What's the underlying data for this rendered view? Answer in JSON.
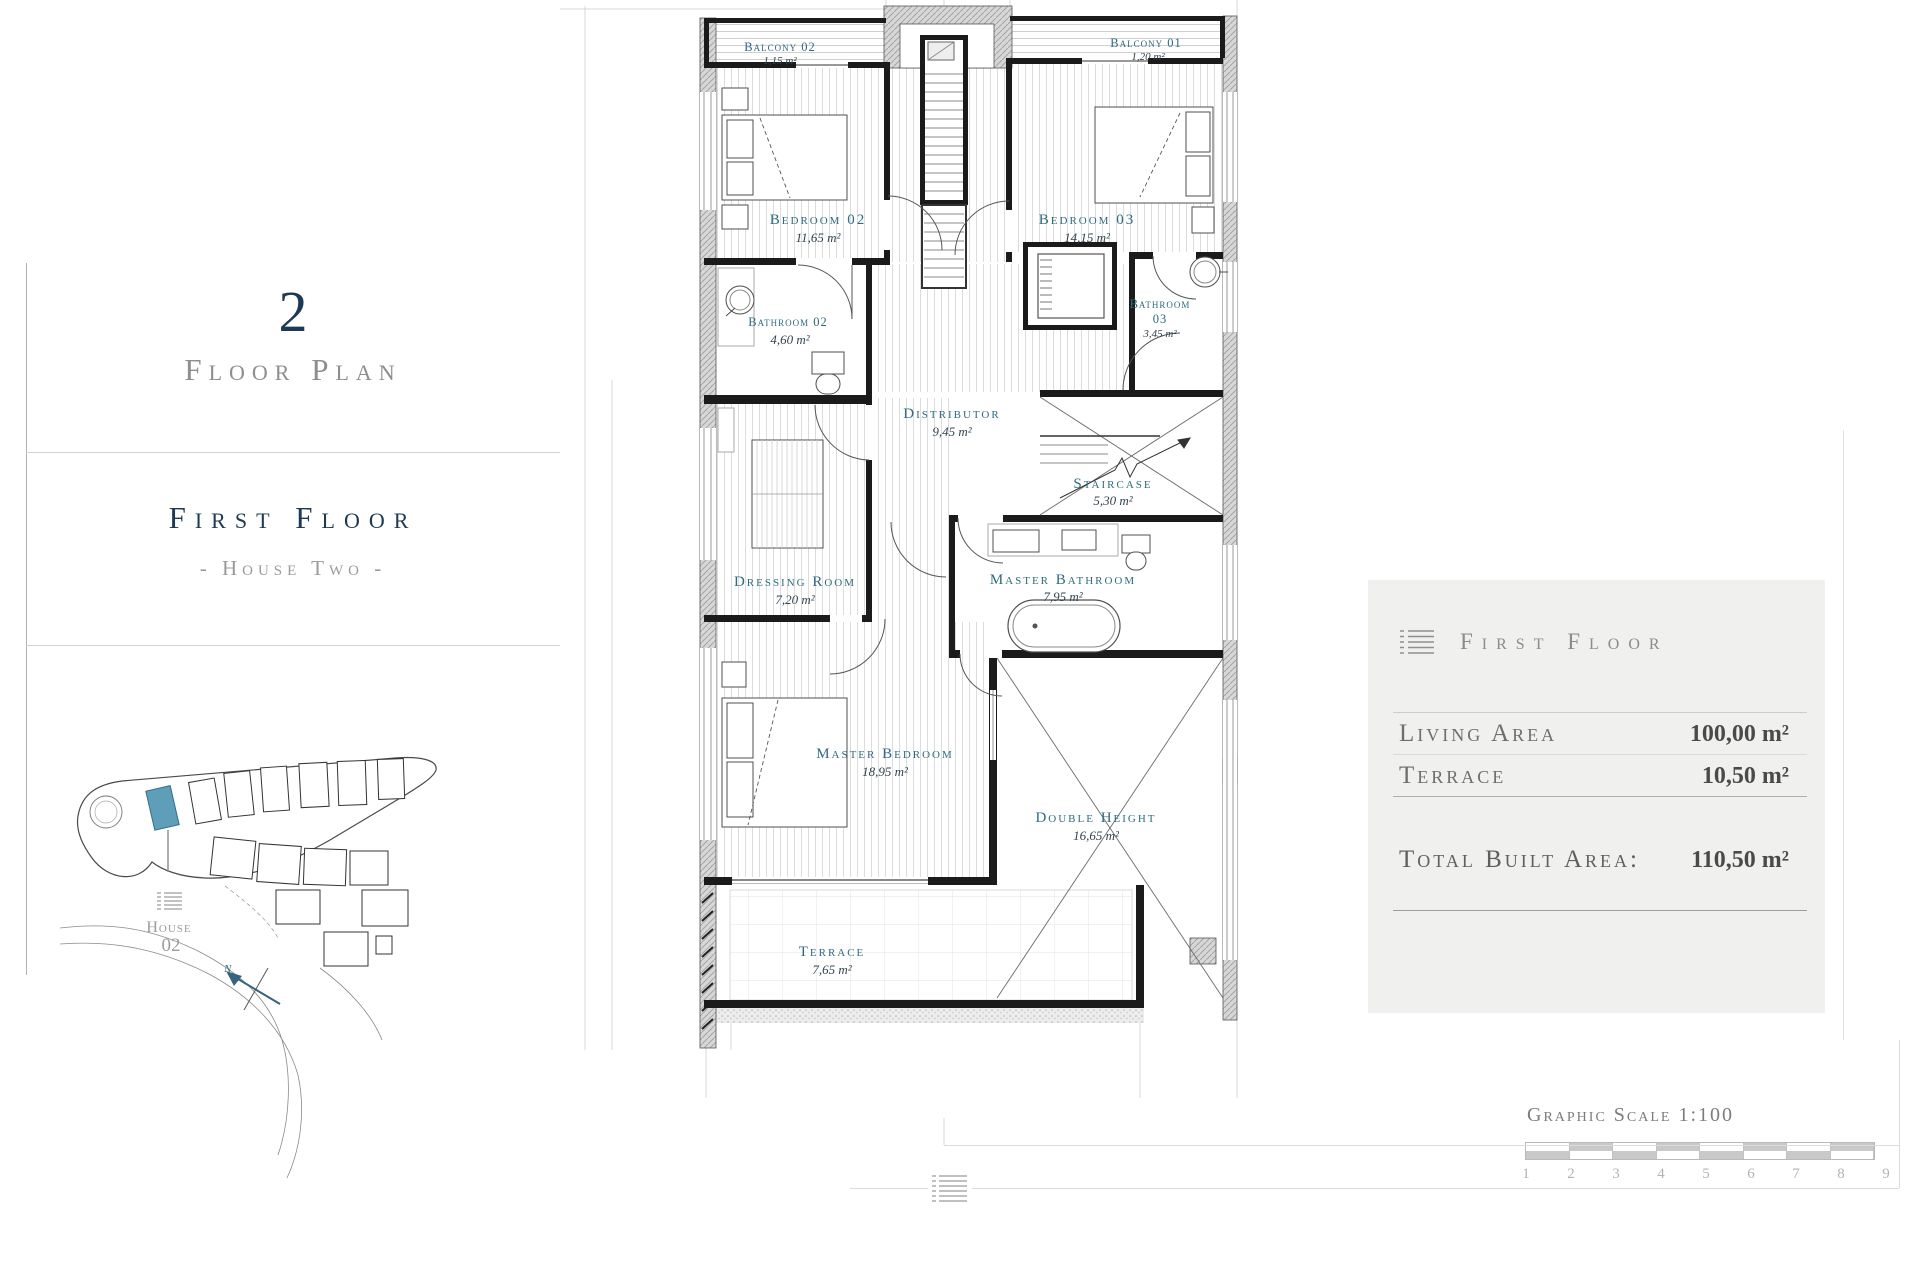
{
  "sidebar": {
    "plan_number": "2",
    "plan_label": "Floor Plan",
    "floor_title": "First Floor",
    "floor_subtitle": "- House Two -",
    "site_plan": {
      "house_label": "House",
      "house_number": "02",
      "compass_n": "N",
      "highlight_color": "#5e9eb9"
    }
  },
  "plan": {
    "label_color": "#2e6b80",
    "rooms": [
      {
        "name": "Balcony 02",
        "area": "1,15 m²"
      },
      {
        "name": "Balcony 01",
        "area": "1,20 m²"
      },
      {
        "name": "Bedroom 02",
        "area": "11,65 m²"
      },
      {
        "name": "Bedroom 03",
        "area": "14,15 m²"
      },
      {
        "name": "Bathroom 02",
        "area": "4,60 m²"
      },
      {
        "name_line1": "Bathroom",
        "name_line2": "03",
        "area": "3,45 m²"
      },
      {
        "name": "Distributor",
        "area": "9,45 m²"
      },
      {
        "name": "Staircase",
        "area": "5,30 m²"
      },
      {
        "name": "Dressing Room",
        "area": "7,20 m²"
      },
      {
        "name": "Master Bathroom",
        "area": "7,95 m²"
      },
      {
        "name": "Master Bedroom",
        "area": "18,95 m²"
      },
      {
        "name": "Double Height",
        "area": "16,65 m²"
      },
      {
        "name": "Terrace",
        "area": "7,65 m²"
      }
    ]
  },
  "summary": {
    "title": "First Floor",
    "rows": [
      {
        "label": "Living Area",
        "value": "100,00 m²"
      },
      {
        "label": "Terrace",
        "value": "10,50 m²"
      }
    ],
    "total_label": "Total Built Area:",
    "total_value": "110,50 m²"
  },
  "scale_bar": {
    "title": "Graphic Scale 1:100",
    "ticks": [
      "1",
      "2",
      "3",
      "4",
      "5",
      "6",
      "7",
      "8",
      "9"
    ]
  }
}
